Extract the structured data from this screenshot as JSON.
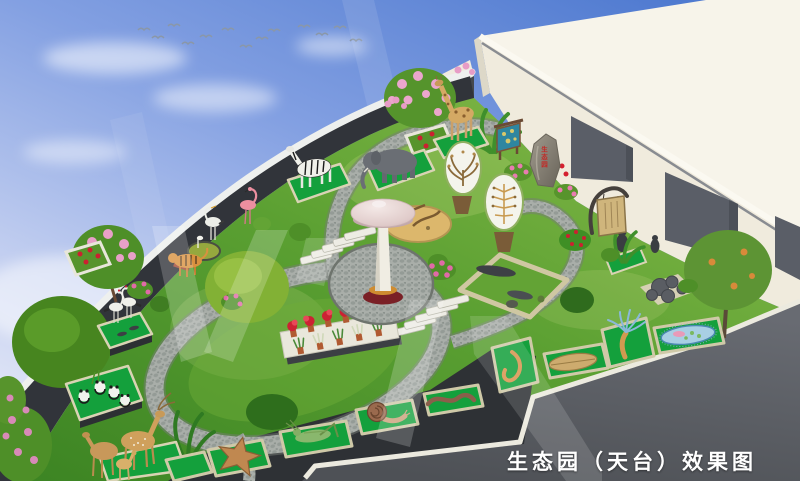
{
  "caption": {
    "text": "生态园（天台）效果图"
  },
  "rock_inscription": {
    "text": "生态园"
  },
  "palette": {
    "sky_top": "#4f7ad0",
    "sky_horizon": "#e9ecf8",
    "building_roof": "#f7f4ea",
    "building_wall": "#f0ebdd",
    "building_opening": "#5a5e67",
    "parapet_wall": "#31343a",
    "parapet_cap": "#eef0ee",
    "terrace": "#5c5f66",
    "curb": "#eceadf",
    "lawn_light": "#8cbd4c",
    "lawn_dark": "#3c8423",
    "mat_green": "#14a03c",
    "path_gravel": "#a9aea9",
    "mushroom_cap": "#e8d7d5",
    "mushroom_stem": "#efece2",
    "mushroom_ring": "#cf8c30",
    "mushroom_base": "#7a2026",
    "caption_color": "#ffffff",
    "inscription_color": "#c22a26"
  },
  "scene": {
    "setting": "bird's-eye rendering of a rooftop ecological garden beside a white penthouse block",
    "sky": {
      "clouds": "soft white clouds",
      "birds": "flock of flying birds",
      "bird_count": 13
    },
    "building": {
      "type": "white penthouse block",
      "openings": 3
    },
    "sculptures": [
      "giraffe",
      "elephant",
      "zebra",
      "flamingo",
      "heron",
      "red-crowned-cranes",
      "tiger",
      "pandas",
      "sika-deer-family",
      "owl-statue",
      "crocodile",
      "salamander",
      "turtle",
      "starfish",
      "grasshopper",
      "snail",
      "earthworm",
      "leech",
      "hydra",
      "paramecium"
    ],
    "features": [
      "mushroom-pavilion",
      "cobblestone-loop-path",
      "stepping-stone-stairs",
      "leaf-shaped-display-boards",
      "map-signboard",
      "hanging-wooden-sign",
      "inscribed-rock",
      "flower-pot-stand",
      "sand-display-bed",
      "pond",
      "rock-cluster",
      "specimen-mats",
      "parapet-wall",
      "flower-beds",
      "trees-and-shrubs"
    ],
    "watermark": "translucent diagonal watermark strokes"
  }
}
